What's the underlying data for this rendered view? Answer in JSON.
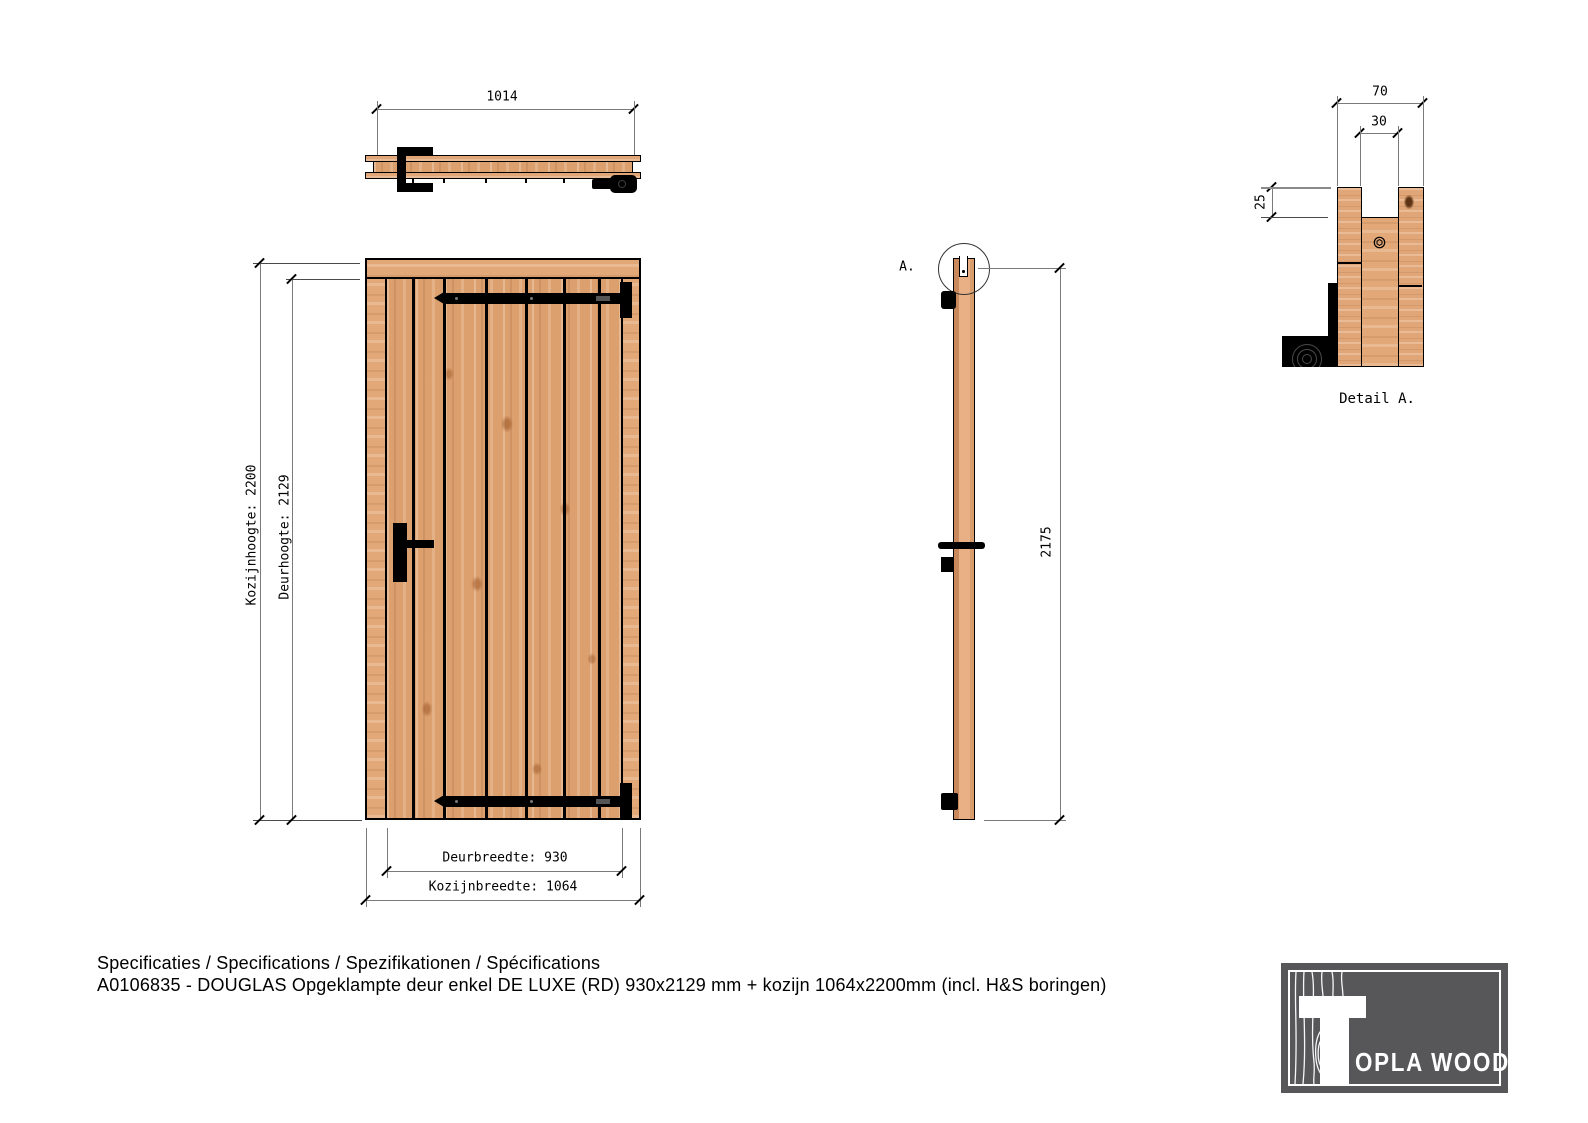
{
  "top_view": {
    "width_dim": "1014"
  },
  "front_view": {
    "frame_height_dim": "Kozijnhoogte: 2200",
    "door_height_dim": "Deurhoogte: 2129",
    "door_width_dim": "Deurbreedte: 930",
    "frame_width_dim": "Kozijnbreedte: 1064"
  },
  "side_view": {
    "height_dim": "2175",
    "detail_marker": "A."
  },
  "detail_a": {
    "outer_width_dim": "70",
    "groove_width_dim": "30",
    "rebate_depth_dim": "25",
    "caption": "Detail A."
  },
  "notes": {
    "line1": "Specificaties / Specifications / Spezifikationen / Spécifications",
    "line2": "A0106835 - DOUGLAS Opgeklampte deur enkel DE LUXE (RD) 930x2129 mm + kozijn 1064x2200mm (incl. H&S boringen)"
  },
  "logo": {
    "brand_mark": "T",
    "brand_text": "OPLA WOOD"
  },
  "colors": {
    "wood_base": "#DCA06F",
    "wood_frame": "#E2A878",
    "hardware": "#000000",
    "dim_line": "#7A7A7A",
    "logo_bg": "#57575A",
    "logo_fg": "#FFFFFF",
    "background": "#FFFFFF"
  }
}
